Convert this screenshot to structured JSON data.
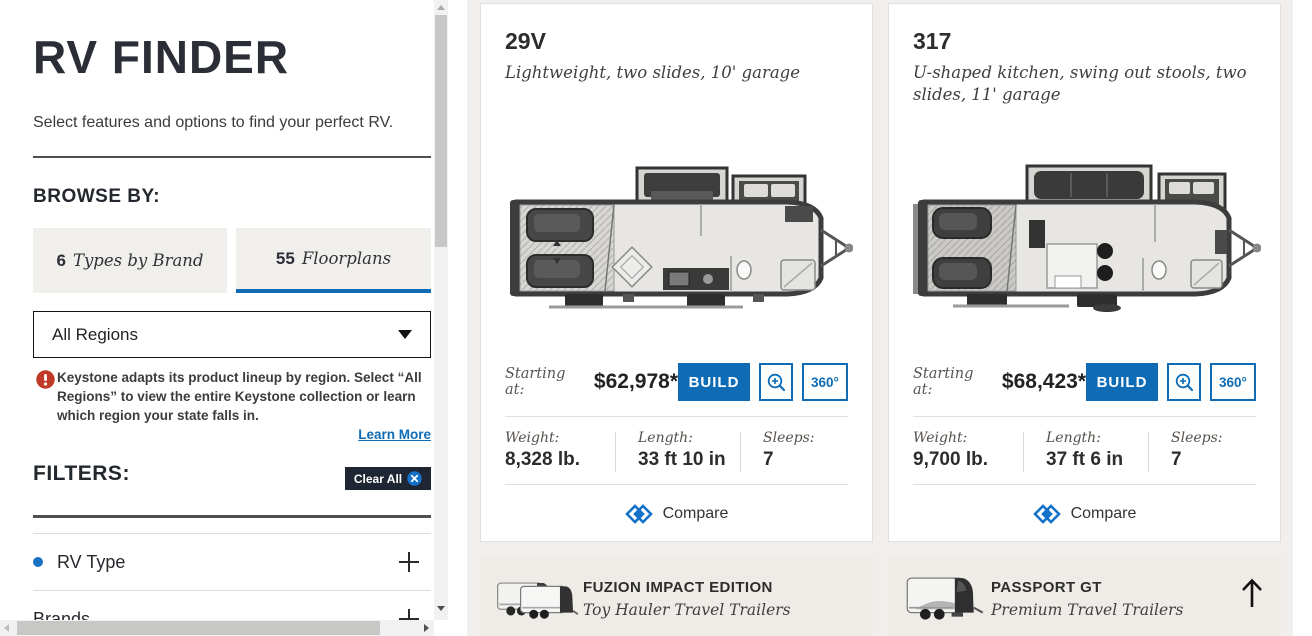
{
  "colors": {
    "accent": "#0d6cb5",
    "navy": "#1e2634",
    "warning_red": "#c13a27"
  },
  "sidebar": {
    "title": "RV FINDER",
    "intro": "Select features and options to find your perfect RV.",
    "browse_by": "BROWSE BY:",
    "tabs": [
      {
        "count": "6",
        "label": "Types by Brand"
      },
      {
        "count": "55",
        "label": "Floorplans"
      }
    ],
    "region_dropdown": {
      "value": "All Regions"
    },
    "region_notice": "Keystone adapts its product lineup by region. Select “All Regions” to view the entire Keystone collection or learn which region your state falls in.",
    "learn_more": "Learn More",
    "filters_heading": "FILTERS:",
    "clear_all_label": "Clear All",
    "filter_groups": [
      {
        "label": "RV Type"
      },
      {
        "label": "Brands"
      }
    ]
  },
  "floorplans": [
    {
      "model": "29V",
      "description": "Lightweight, two slides, 10' garage",
      "starting_at_label": "Starting at:",
      "price": "$62,978*",
      "build_label": "BUILD",
      "view_360_label": "360°",
      "specs": {
        "weight_label": "Weight:",
        "weight": "8,328 lb.",
        "length_label": "Length:",
        "length": "33 ft 10 in",
        "sleeps_label": "Sleeps:",
        "sleeps": "7"
      },
      "compare_label": "Compare"
    },
    {
      "model": "317",
      "description": "U-shaped kitchen, swing out stools, two slides, 11' garage",
      "starting_at_label": "Starting at:",
      "price": "$68,423*",
      "build_label": "BUILD",
      "view_360_label": "360°",
      "specs": {
        "weight_label": "Weight:",
        "weight": "9,700 lb.",
        "length_label": "Length:",
        "length": "37 ft 6 in",
        "sleeps_label": "Sleeps:",
        "sleeps": "7"
      },
      "compare_label": "Compare"
    }
  ],
  "promos": [
    {
      "title": "FUZION IMPACT EDITION",
      "subtitle": "Toy Hauler Travel Trailers"
    },
    {
      "title": "PASSPORT GT",
      "subtitle": "Premium Travel Trailers"
    }
  ]
}
